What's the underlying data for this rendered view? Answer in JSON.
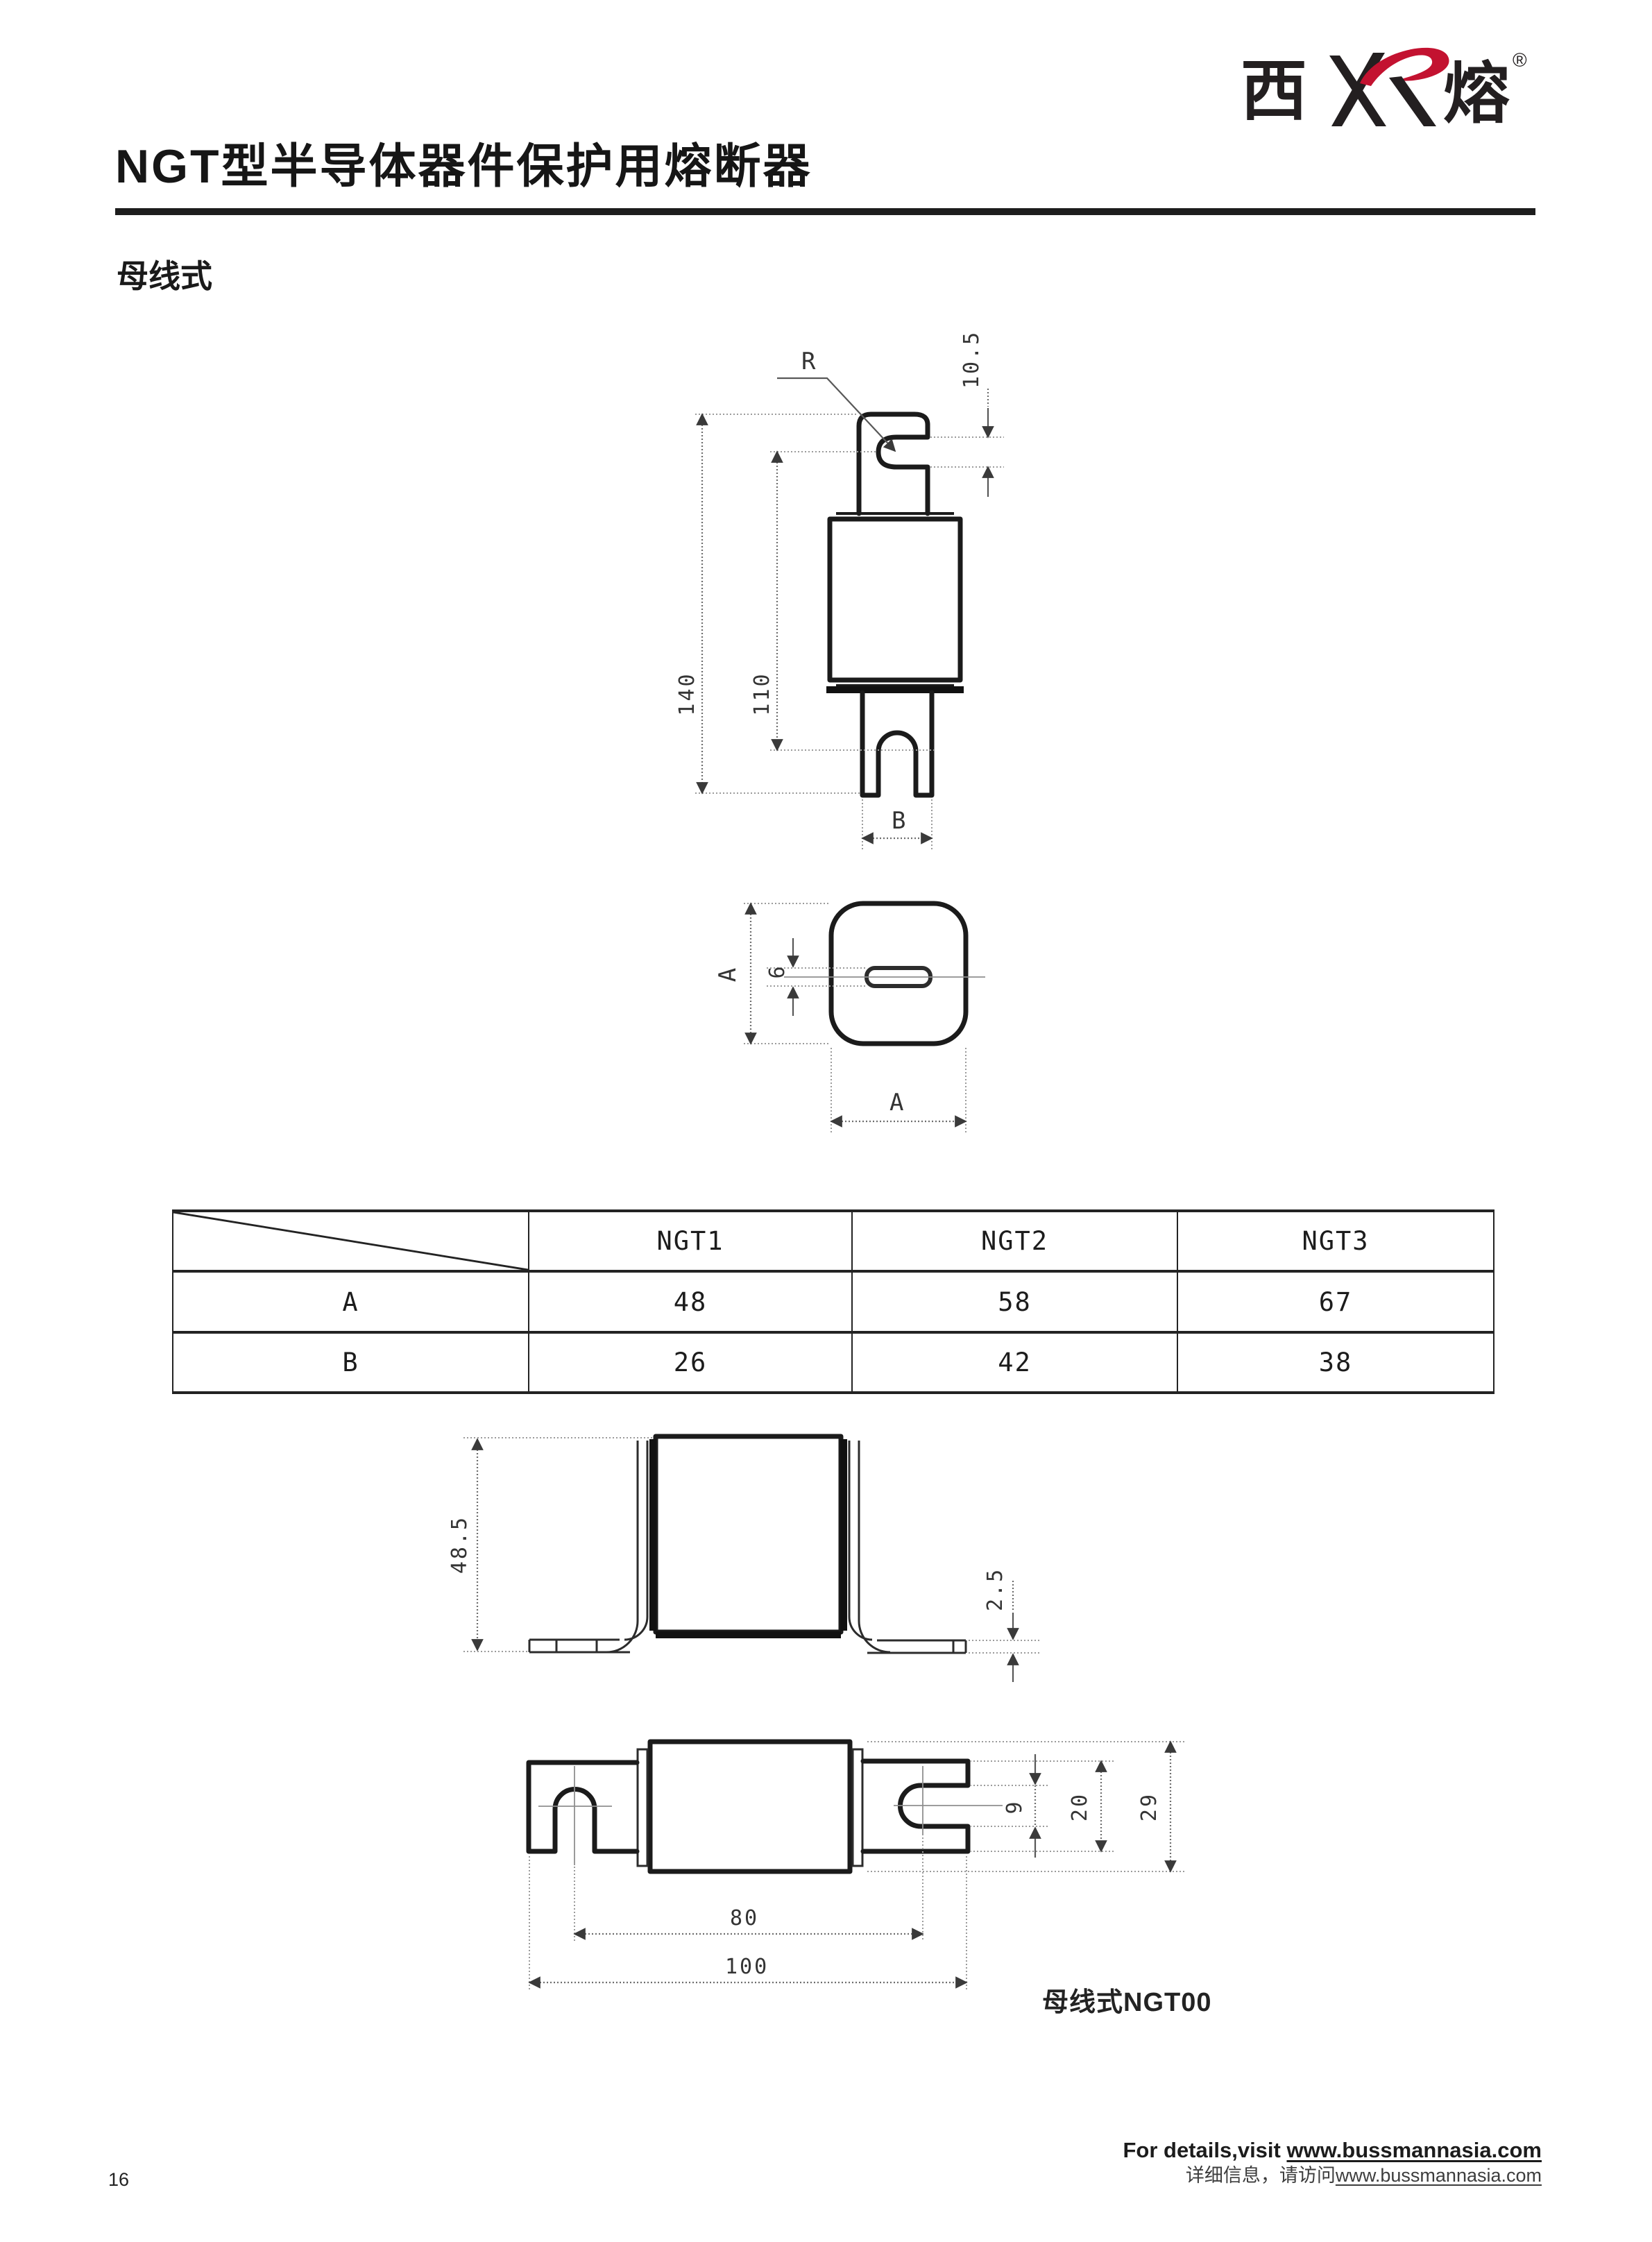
{
  "logo": {
    "char_west": "西",
    "char_rong": "熔",
    "registered": "®",
    "red": "#c31230",
    "black": "#231f20"
  },
  "header": {
    "title": "NGT型半导体器件保护用熔断器",
    "subtitle": "母线式"
  },
  "figure1": {
    "labels": {
      "radius": "R",
      "notch_height": "10.5",
      "overall_height": "140",
      "inner_height": "110",
      "blade_width": "B",
      "body_width_side": "A",
      "slot_width": "6",
      "body_width_bottom": "A"
    }
  },
  "dim_table": {
    "col_headers": [
      "NGT1",
      "NGT2",
      "NGT3"
    ],
    "rows": [
      {
        "label": "A",
        "values": [
          "48",
          "58",
          "67"
        ]
      },
      {
        "label": "B",
        "values": [
          "26",
          "42",
          "38"
        ]
      }
    ]
  },
  "figure2": {
    "labels": {
      "bracket_height": "48.5",
      "foot_thickness": "2.5"
    }
  },
  "figure3": {
    "labels": {
      "slot_width": "9",
      "tab_height": "20",
      "body_height": "29",
      "notch_span": "80",
      "overall_length": "100"
    },
    "caption": "母线式NGT00"
  },
  "footer": {
    "en_prefix": "For details,visit ",
    "en_url": "www.bussmannasia.com",
    "cn_prefix": "详细信息，请访问",
    "cn_url": "www.bussmannasia.com",
    "page_number": "16"
  }
}
